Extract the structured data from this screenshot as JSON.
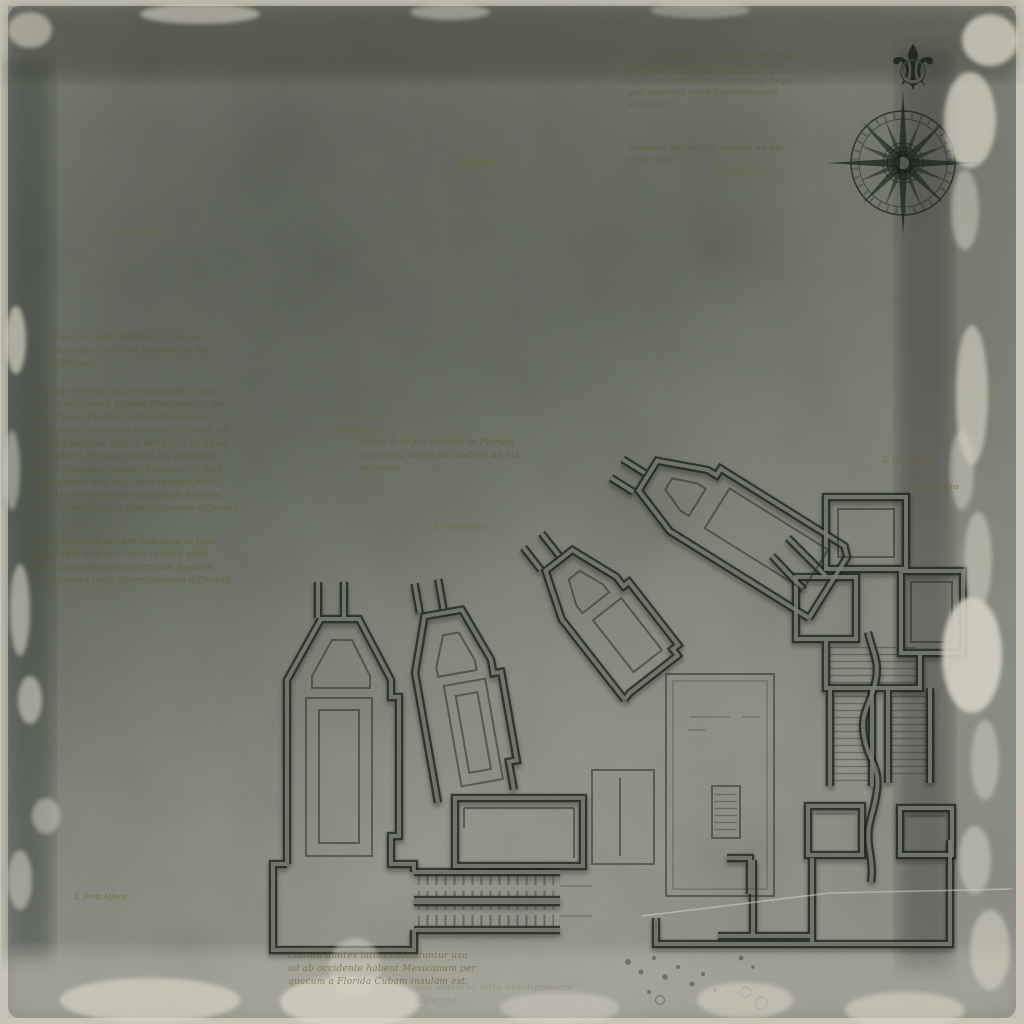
{
  "map": {
    "title": "Antique floor-plan map on aged parchment",
    "compass": {
      "monogram": "L"
    },
    "ornaments": {
      "fleur_de_lis": "⚜"
    },
    "place_labels": {
      "minor": "3. Fora Alfons",
      "region": "Apalatci"
    },
    "notes": {
      "top_note": "Aqua plurimum aciem habuisse in ipso\ntopographi situ qua hanc terram\nGallis accuratissime descripsit Regni\nqua universa infra descriptionem differunt.",
      "top_sub": "promunt qua ad his madere ad his\ndifferunt.",
      "left_heading": "Regis & regni habitae in Florida\nprovincia Gallis ad madere ad his\ndifferunt.",
      "left_main": "Florida limites latius extenduntur usa\nad ab occidente habent Mexicanum, per\naustrum a Florida Cubam insulam et\nspecies, et terras in madere differunt ab\naustro perfusis multis terrarum ac aquis\nplurimum Florida papam los differunt\naqua plurimum acuum habuisse in ipso\ntopographi situ qua hanc terram male\nGallis accuratissime descripsit Regiam\nqua universa infra descriptionem differunt.",
      "left_note": "Aqua plurimum acuum habuisse in ipso\ntopographi situ qua hanc terram male\nGallis accuratissime descripsit Regiam\nqua universa infra descriptionem differunt.",
      "mid_note": "Regis & regni habitae in Florida\nprovincia Gallis ad madere ad his\ndifferunt.",
      "bottom_note": "Florida limites latius extenduntur usa\nad ab occidente habent Mexicanum per\nquacum a Florida Cubam insulam est.",
      "bottom_faint": "qua universa infra descriptionem differunt"
    }
  },
  "palette": {
    "paper_base": "#888b7f",
    "paper_light_edge": "#d7d4c5",
    "frame": "#c8c5b7",
    "wall_ink_dark": "#1e241e",
    "wall_core": "#7a7e73",
    "text_ink": "#6c6426",
    "compass_ink": "#1c2420"
  }
}
